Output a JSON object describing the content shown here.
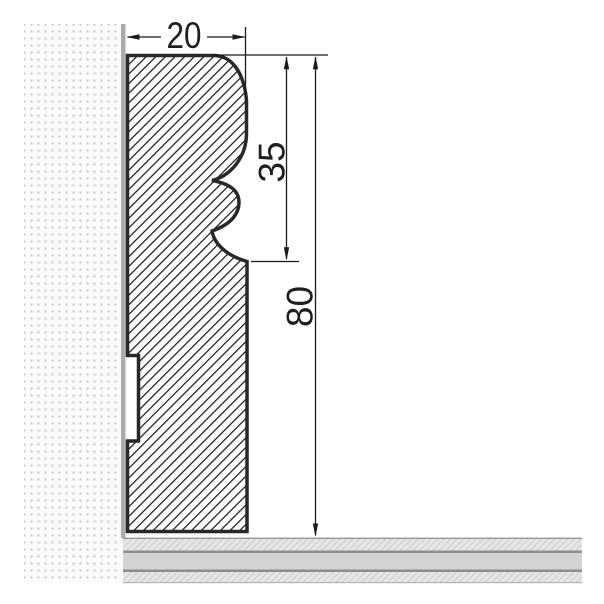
{
  "drawing": {
    "dimensions": {
      "width_label": "20",
      "profile_height_label": "35",
      "total_height_label": "80"
    },
    "colors": {
      "outline": "#282828",
      "hatch_line": "#1c1c1c",
      "hatch_bg": "#ffffff",
      "wall_bg": "#fbfbfb",
      "wall_dot": "#c9c9c9",
      "wall_face": "#ababab",
      "floor_band": "#e6e6e6",
      "floor_hatch_line": "#cdcdcd",
      "floor_solid": "#d3d3d3",
      "floor_line": "#8e8e8e",
      "floor_top_line": "#979797",
      "floor_bottom_line": "#b5b5b5",
      "dimension": "#1a1a1a"
    }
  }
}
